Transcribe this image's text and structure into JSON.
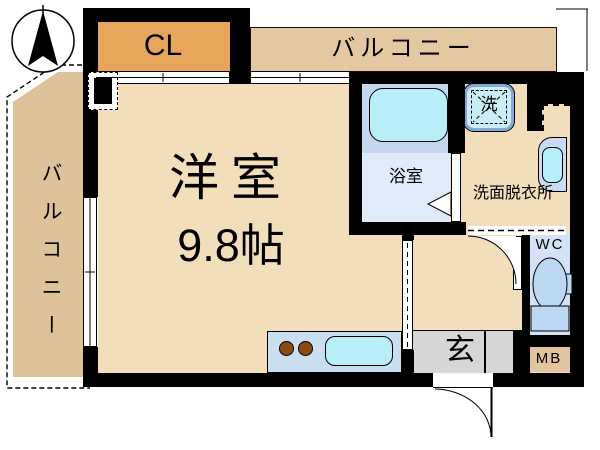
{
  "plan": {
    "compass": "north-arrow",
    "closet": "CL",
    "balcony_top": "バルコニー",
    "balcony_left": "バルコニー",
    "main_room": "洋室",
    "main_room_size": "9.8帖",
    "bathroom": "浴室",
    "washing_machine": "洗",
    "washroom": "洗面脱衣所",
    "wc": "WC",
    "meter_box": "MB",
    "entrance": "玄"
  },
  "colors": {
    "wall": "#000000",
    "room_floor": "#f2deba",
    "balcony_top": "#e4c8a2",
    "balcony_left": "#dec29a",
    "closet": "#e8a55c",
    "bath_platform": "#c5d6ef",
    "bath_floor": "#e0ebfa",
    "water_cyan": "#b8eef8",
    "kitchen_counter": "#cadef2",
    "wc_floor": "#d3e2f6",
    "toilet_fixture": "#bcd7f2",
    "entrance_floor": "#d6d6d6",
    "meter_box": "#e2c49e",
    "burner": "#8a4a12"
  }
}
